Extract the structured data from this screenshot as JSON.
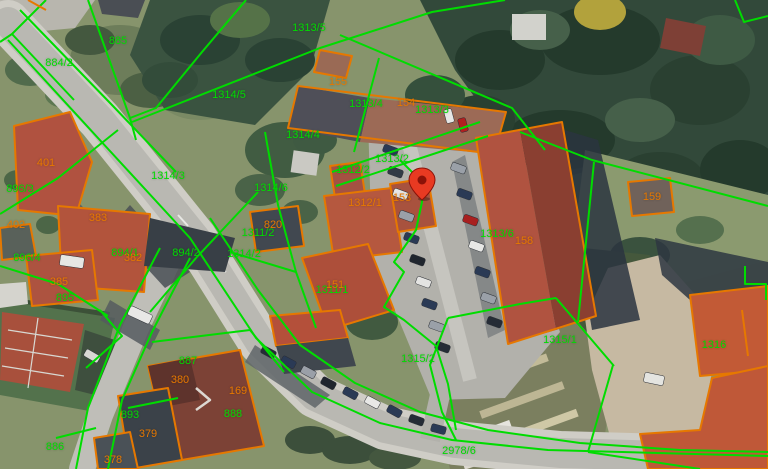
{
  "map": {
    "colors": {
      "parcel_line": "#00DC00",
      "building_line": "#E67800",
      "pin": "#E83A22"
    },
    "pin": {
      "x": 422,
      "y": 182
    },
    "labels": [
      {
        "text": "885",
        "kind": "parcel",
        "x": 118,
        "y": 41
      },
      {
        "text": "884/2",
        "kind": "parcel",
        "x": 59,
        "y": 63
      },
      {
        "text": "1313/5",
        "kind": "parcel",
        "x": 309,
        "y": 28
      },
      {
        "text": "1314/5",
        "kind": "parcel",
        "x": 229,
        "y": 95
      },
      {
        "text": "1313/4",
        "kind": "parcel",
        "x": 366,
        "y": 104
      },
      {
        "text": "1313/3",
        "kind": "parcel",
        "x": 432,
        "y": 110
      },
      {
        "text": "1314/4",
        "kind": "parcel",
        "x": 303,
        "y": 135
      },
      {
        "text": "1313/2",
        "kind": "parcel",
        "x": 392,
        "y": 159
      },
      {
        "text": "1312/2",
        "kind": "parcel",
        "x": 353,
        "y": 170
      },
      {
        "text": "1314/3",
        "kind": "parcel",
        "x": 168,
        "y": 176
      },
      {
        "text": "896/3",
        "kind": "parcel",
        "x": 20,
        "y": 189
      },
      {
        "text": "1314/6",
        "kind": "parcel",
        "x": 271,
        "y": 188
      },
      {
        "text": "1311/2",
        "kind": "parcel",
        "x": 258,
        "y": 233
      },
      {
        "text": "1313/6",
        "kind": "parcel",
        "x": 497,
        "y": 234
      },
      {
        "text": "894/1",
        "kind": "parcel",
        "x": 125,
        "y": 253
      },
      {
        "text": "894/2",
        "kind": "parcel",
        "x": 186,
        "y": 253
      },
      {
        "text": "1314/2",
        "kind": "parcel",
        "x": 244,
        "y": 254
      },
      {
        "text": "896/4",
        "kind": "parcel",
        "x": 27,
        "y": 258
      },
      {
        "text": "895",
        "kind": "parcel",
        "x": 65,
        "y": 298
      },
      {
        "text": "1311/1",
        "kind": "parcel",
        "x": 332,
        "y": 290
      },
      {
        "text": "1315/2",
        "kind": "parcel",
        "x": 418,
        "y": 359
      },
      {
        "text": "1315/1",
        "kind": "parcel",
        "x": 560,
        "y": 340
      },
      {
        "text": "1316",
        "kind": "parcel",
        "x": 714,
        "y": 345
      },
      {
        "text": "887",
        "kind": "parcel",
        "x": 188,
        "y": 361
      },
      {
        "text": "893",
        "kind": "parcel",
        "x": 130,
        "y": 415
      },
      {
        "text": "888",
        "kind": "parcel",
        "x": 233,
        "y": 414
      },
      {
        "text": "886",
        "kind": "parcel",
        "x": 55,
        "y": 447
      },
      {
        "text": "2978/6",
        "kind": "parcel",
        "x": 459,
        "y": 451
      },
      {
        "text": "155",
        "kind": "building",
        "x": 338,
        "y": 82
      },
      {
        "text": "154",
        "kind": "building",
        "x": 406,
        "y": 103
      },
      {
        "text": "401",
        "kind": "building",
        "x": 46,
        "y": 163
      },
      {
        "text": "402",
        "kind": "building",
        "x": 16,
        "y": 225
      },
      {
        "text": "383",
        "kind": "building",
        "x": 98,
        "y": 218
      },
      {
        "text": "153",
        "kind": "building",
        "x": 402,
        "y": 198
      },
      {
        "text": "1312/1",
        "kind": "building",
        "x": 365,
        "y": 203
      },
      {
        "text": "820",
        "kind": "building",
        "x": 273,
        "y": 225
      },
      {
        "text": "382",
        "kind": "building",
        "x": 133,
        "y": 258
      },
      {
        "text": "385",
        "kind": "building",
        "x": 59,
        "y": 282
      },
      {
        "text": "159",
        "kind": "building",
        "x": 652,
        "y": 197
      },
      {
        "text": "158",
        "kind": "building",
        "x": 524,
        "y": 241
      },
      {
        "text": "151",
        "kind": "building",
        "x": 335,
        "y": 285
      },
      {
        "text": "380",
        "kind": "building",
        "x": 180,
        "y": 380
      },
      {
        "text": "169",
        "kind": "building",
        "x": 238,
        "y": 391
      },
      {
        "text": "379",
        "kind": "building",
        "x": 148,
        "y": 434
      },
      {
        "text": "378",
        "kind": "building",
        "x": 113,
        "y": 460
      }
    ]
  }
}
